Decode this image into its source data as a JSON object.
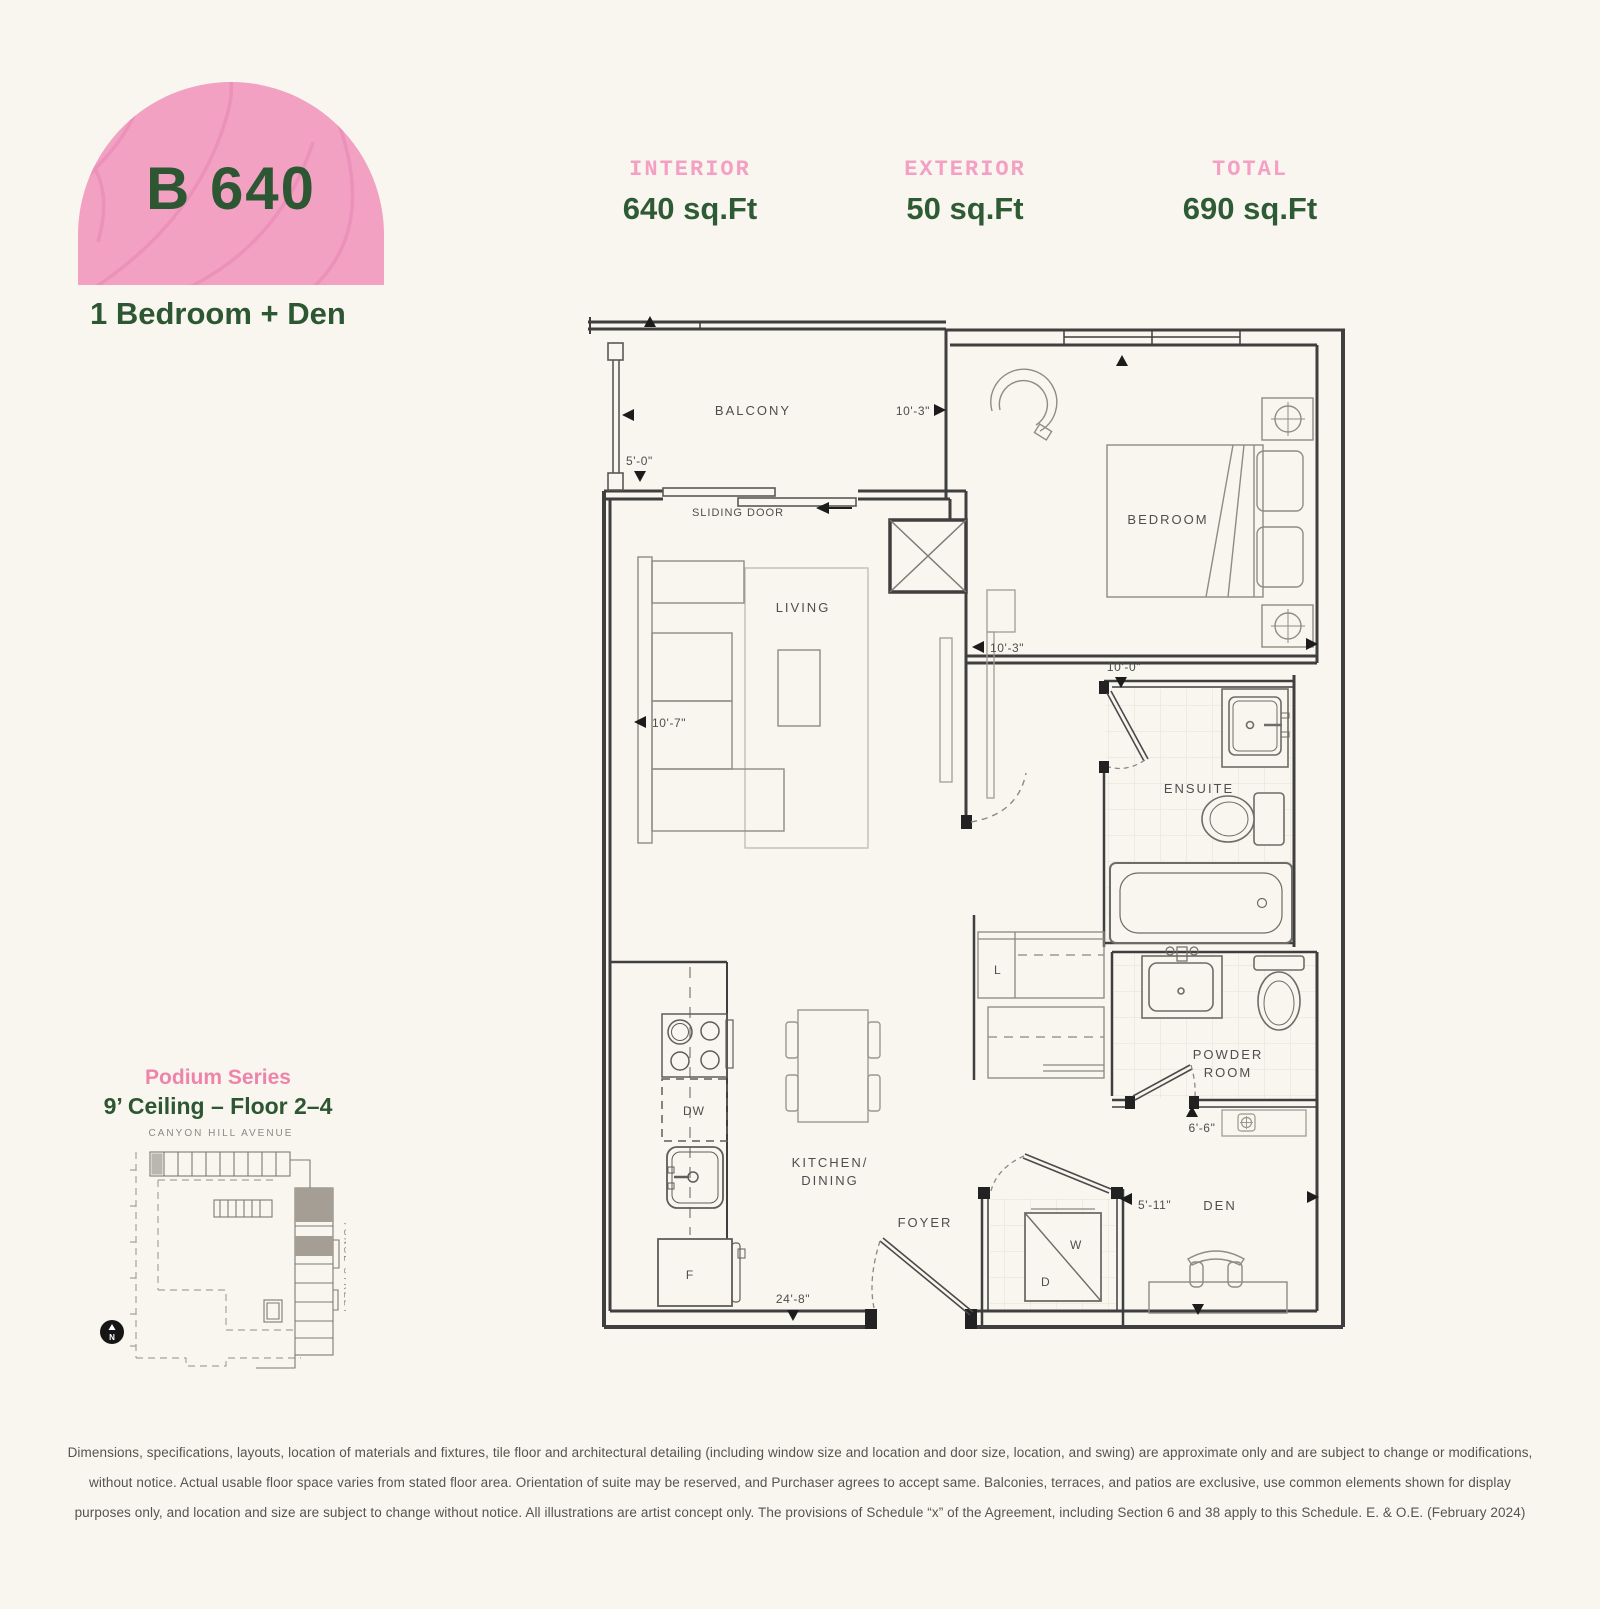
{
  "header": {
    "unit_code": "B 640",
    "unit_type": "1 Bedroom + Den",
    "stats": [
      {
        "label": "INTERIOR",
        "value": "640 sq.Ft"
      },
      {
        "label": "EXTERIOR",
        "value": "50 sq.Ft"
      },
      {
        "label": "TOTAL",
        "value": "690 sq.Ft"
      }
    ]
  },
  "floorplan": {
    "labels": {
      "balcony": "BALCONY",
      "sliding_door": "SLIDING DOOR",
      "living": "LIVING",
      "bedroom": "BEDROOM",
      "ensuite": "ENSUITE",
      "kitchen_line1": "KITCHEN/",
      "kitchen_line2": "DINING",
      "foyer": "FOYER",
      "powder_line1": "POWDER",
      "powder_line2": "ROOM",
      "den": "DEN",
      "dishwasher": "DW",
      "fridge": "F",
      "washer": "W",
      "dryer": "D",
      "linen": "L"
    },
    "dimensions": {
      "balcony_width": "10'-3\"",
      "balcony_depth": "5'-0\"",
      "living_width": "10'-7\"",
      "bedroom_width": "10'-3\"",
      "ensuite_width": "10'-0\"",
      "powder_width": "6'-6\"",
      "den_width": "5'-11\"",
      "unit_width": "24'-8\""
    }
  },
  "keyplan": {
    "series": "Podium Series",
    "ceiling": "9’ Ceiling – Floor 2–4",
    "street_top": "CANYON HILL AVENUE",
    "street_right": "YONGE STREET",
    "north": "N"
  },
  "disclaimer": {
    "line1": "Dimensions, specifications, layouts, location of materials and fixtures, tile floor and architectural detailing (including window size and location and door size, location, and swing) are approximate only and are subject to change or modifications,",
    "line2": "without notice. Actual usable floor space varies from stated floor area. Orientation of suite may be reserved, and Purchaser agrees to accept same. Balconies, terraces, and patios are exclusive, use common elements shown for display",
    "line3": "purposes only, and location and size are subject to change without notice. All illustrations are artist concept only. The provisions of Schedule “x” of the Agreement, including Section 6 and 38 apply to this Schedule. E. & O.E. (February 2024)"
  },
  "colors": {
    "background": "#f8f6ee",
    "accent_pink": "#f2a1c3",
    "accent_green": "#2d5632",
    "wall": "#3f3f3f",
    "keyplan_highlight": "#a59e94"
  }
}
